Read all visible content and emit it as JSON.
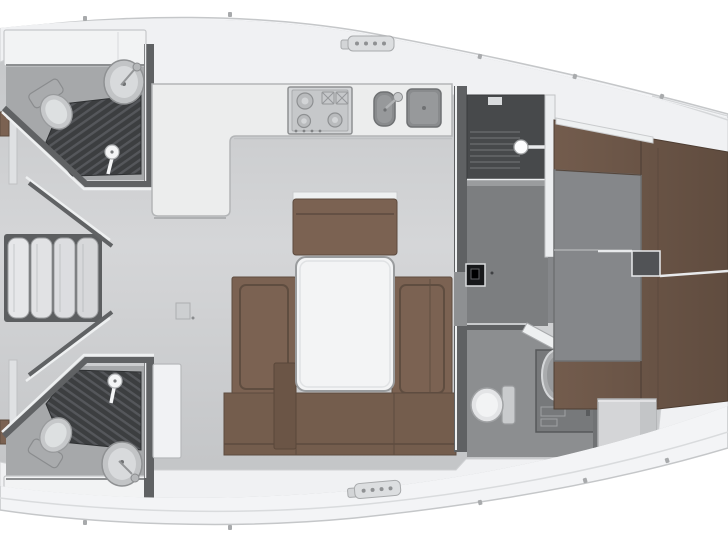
{
  "document": {
    "title": "Sailing yacht interior floor plan",
    "type": "floor-plan",
    "view": "top-down",
    "orientation": "bow-right"
  },
  "colors": {
    "page": "#ffffff",
    "hull": "#f3f4f6",
    "hull_edge": "#c5c7c9",
    "deck": "#f0f1f3",
    "deck_seam": "#d9dbdd",
    "floor": "#cdcfd1",
    "floor_head": "#a6a8aa",
    "floor_passage": "#7c7e80",
    "floor_cabin": "#85878a",
    "wall_dark": "#5f6163",
    "wall_trim": "#eceef0",
    "wood": "#7b6252",
    "wood_dark": "#6b5546",
    "wood_seat": "#745d4d",
    "berth": "#6e5849",
    "grate": "#3c3e40",
    "counter": "#eceded",
    "fixture_white": "#f2f3f4",
    "steel": "#898b8d",
    "stove": "#d2d4d6",
    "panel_black": "#17181a",
    "white_line": "#e8eaec",
    "step_box": "#d4d5d7"
  },
  "rooms": [
    {
      "id": "aft-head-port",
      "label": "Aft head with shower (port)"
    },
    {
      "id": "aft-head-starboard",
      "label": "Aft head with shower (starboard)"
    },
    {
      "id": "companionway",
      "label": "Companionway steps"
    },
    {
      "id": "galley",
      "label": "L-shaped galley"
    },
    {
      "id": "salon",
      "label": "Salon with U-shaped settee and table"
    },
    {
      "id": "wardrobe",
      "label": "Wardrobe and dressing area"
    },
    {
      "id": "forward-head",
      "label": "Forward head"
    },
    {
      "id": "forward-cabin",
      "label": "Forward cabin with V-berth"
    }
  ],
  "fixtures": {
    "stove": "3-burner stove",
    "galley_sinks": "Double galley sink",
    "toilet": "Marine toilet",
    "wash_basin": "Wash basin",
    "shower_grate": "Shower floor grating",
    "shower_mixer": "Shower mixer",
    "table": "Salon table",
    "settee": "Upholstered settee",
    "vberth": "V-berth mattress",
    "hanging_locker": "Hanging locker",
    "steps": "Companionway steps (4 treads)",
    "electrical_panel": "Electrical panel",
    "step_box": "Cabin entry step",
    "deck_fitting": "Deck clutch fitting"
  }
}
